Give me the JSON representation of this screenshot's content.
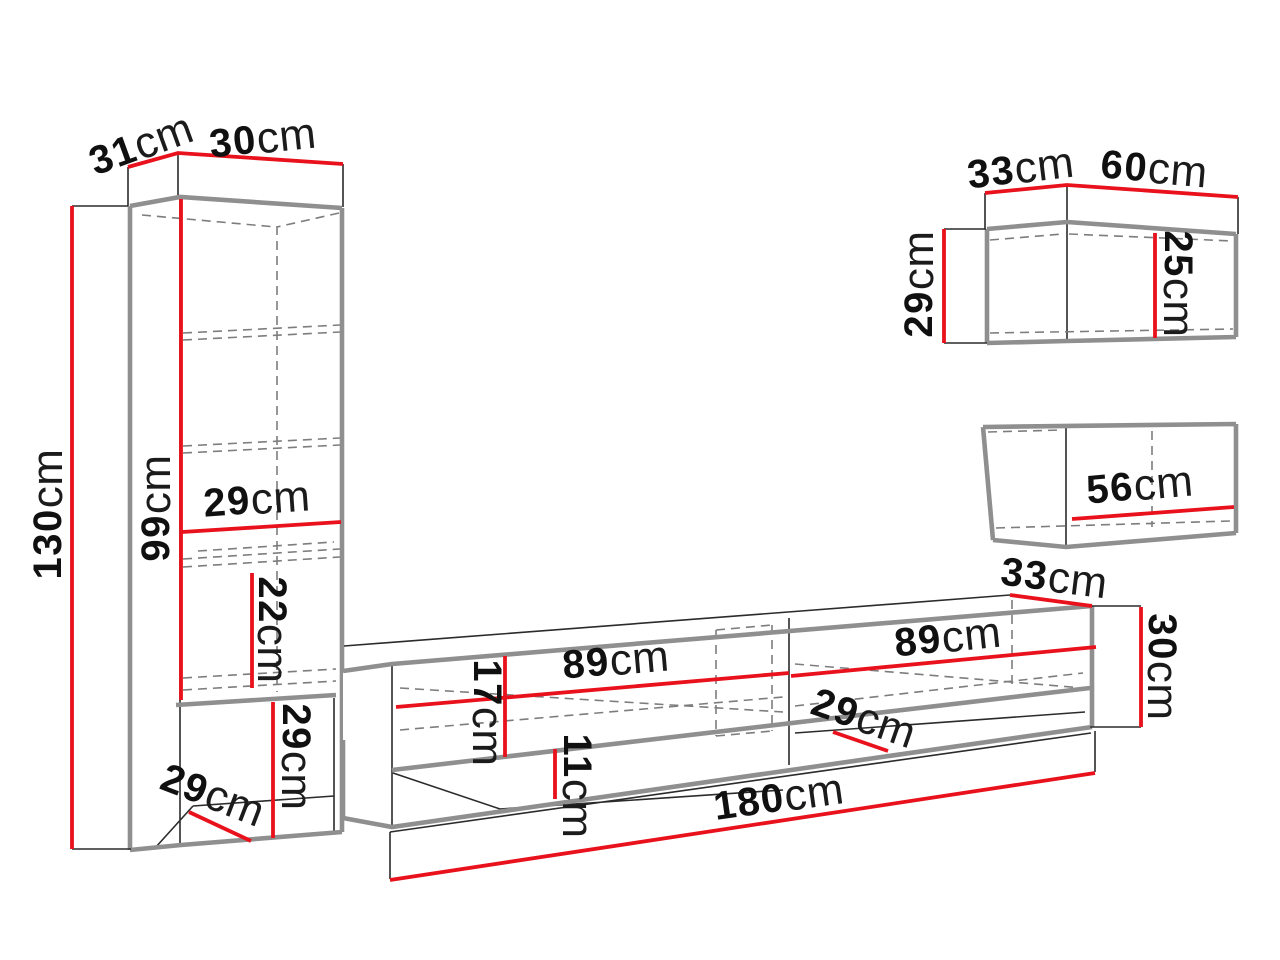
{
  "unit": "cm",
  "colors": {
    "dimension": "#e8111c",
    "edge": "#8f8f8f",
    "line": "#2b2b2b",
    "hidden": "#7d7d7d"
  },
  "tall_cabinet": {
    "top_depth": "31",
    "top_width": "30",
    "height": "130",
    "inner_height": "99",
    "inner_width": "29",
    "shelf_spacing": "22",
    "niche_height": "29",
    "niche_depth": "29"
  },
  "tv_stand": {
    "width": "180",
    "left_section_width": "89",
    "right_section_width": "89",
    "open_niche_height": "17",
    "lower_niche_height": "11",
    "inner_depth": "29",
    "top_depth": "33",
    "side_height": "30"
  },
  "upper_wall_cabinet": {
    "depth": "33",
    "width": "60",
    "height": "29",
    "inner_height": "25"
  },
  "lower_wall_cabinet": {
    "inner_width": "56"
  }
}
